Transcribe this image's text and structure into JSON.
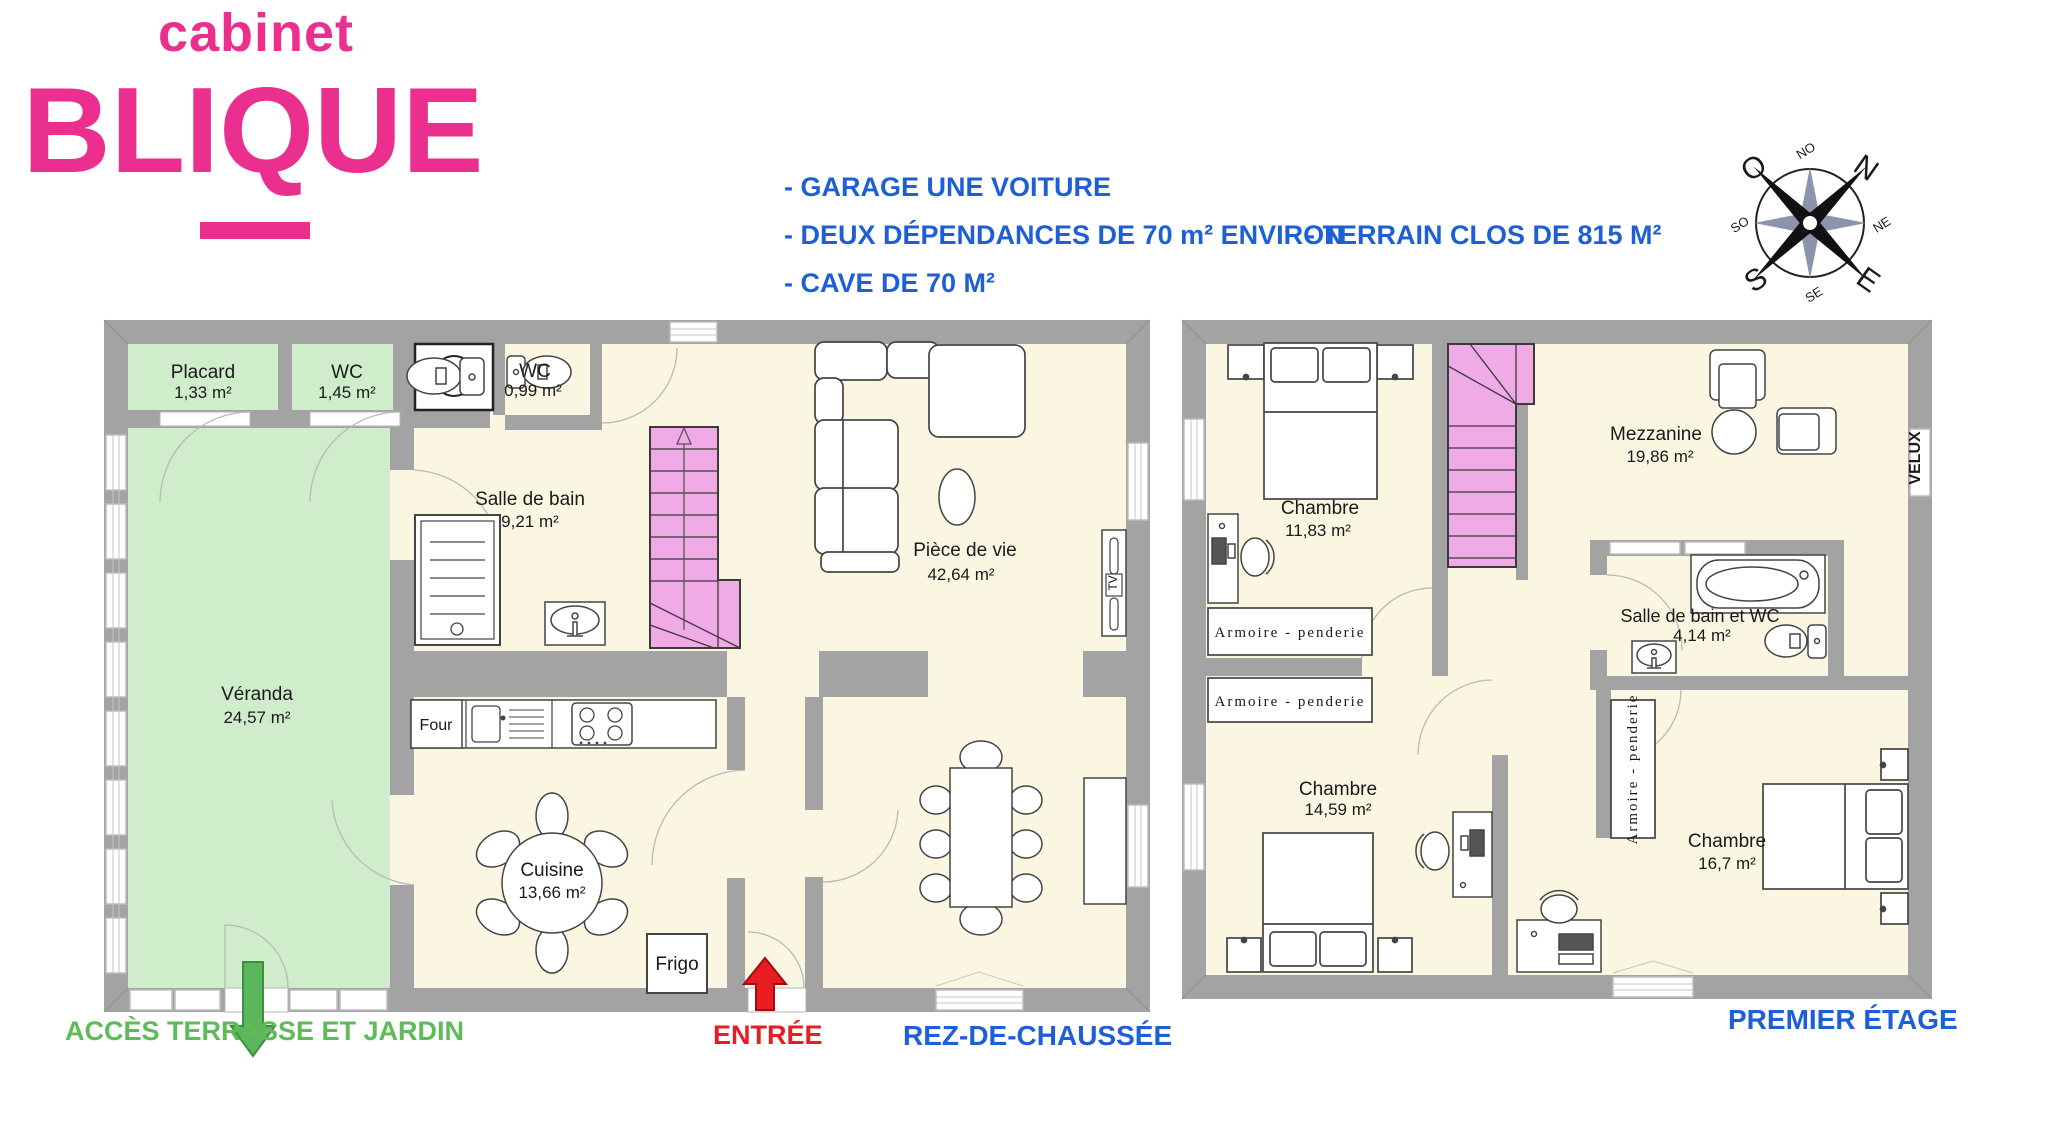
{
  "logo": {
    "line1": "cabinet",
    "line2": "BLIQUE"
  },
  "features": {
    "item1": "- GARAGE UNE VOITURE",
    "item2": "- DEUX DÉPENDANCES DE 70 m² ENVIRON",
    "item3": "- TERRAIN CLOS DE 815 M²",
    "item4": "- CAVE DE 70 M²"
  },
  "colors": {
    "brand_pink": "#ea2f8e",
    "text_blue": "#1d5fd6",
    "text_green": "#5fbb58",
    "text_red": "#e91c23",
    "wall_gray": "#a3a3a3",
    "floor_cream": "#faf6e1",
    "room_green": "#cfeccb",
    "stairs_pink": "#f0aae6"
  },
  "compass": {
    "n": "N",
    "s": "S",
    "e": "E",
    "o": "O",
    "ne": "NE",
    "no": "NO",
    "se": "SE",
    "so": "SO"
  },
  "ground_floor": {
    "title": "REZ-DE-CHAUSSÉE",
    "entry_label": "ENTRÉE",
    "terrace_label": "ACCÈS TERRASSE ET JARDIN",
    "rooms": {
      "placard": {
        "name": "Placard",
        "area": "1,33 m²"
      },
      "wc1": {
        "name": "WC",
        "area": "1,45 m²"
      },
      "wc2": {
        "name": "WC",
        "area": "0,99 m²"
      },
      "salle_de_bain": {
        "name": "Salle de bain",
        "area": "9,21 m²"
      },
      "veranda": {
        "name": "Véranda",
        "area": "24,57 m²"
      },
      "piece_de_vie": {
        "name": "Pièce de vie",
        "area": "42,64 m²"
      },
      "cuisine": {
        "name": "Cuisine",
        "area": "13,66 m²"
      }
    },
    "furniture": {
      "four": "Four",
      "frigo": "Frigo",
      "tv": "TV"
    }
  },
  "first_floor": {
    "title": "PREMIER ÉTAGE",
    "rooms": {
      "chambre1": {
        "name": "Chambre",
        "area": "11,83 m²"
      },
      "mezzanine": {
        "name": "Mezzanine",
        "area": "19,86 m²"
      },
      "salle_de_bain_wc": {
        "name": "Salle de bain et WC",
        "area": "4,14 m²"
      },
      "chambre2": {
        "name": "Chambre",
        "area": "14,59 m²"
      },
      "chambre3": {
        "name": "Chambre",
        "area": "16,7 m²"
      }
    },
    "labels": {
      "armoire": "Armoire - penderie",
      "velux": "VELUX"
    }
  }
}
